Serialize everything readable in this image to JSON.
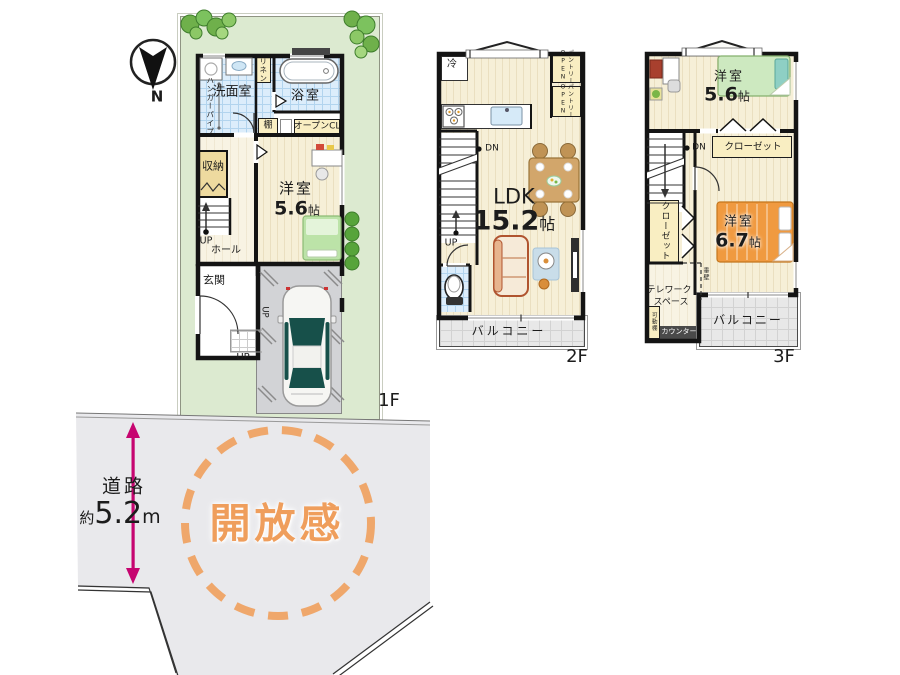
{
  "compass": {
    "north": "N"
  },
  "site": {
    "road": "道路",
    "approx": "約",
    "road_width": "5.2",
    "unit_m": "m",
    "openness": "開放感"
  },
  "units": {
    "jo": "帖"
  },
  "f1": {
    "label": "1F",
    "washroom": "洗面室",
    "bath": "浴室",
    "linen": "リネン",
    "hanger_pipe": "ハンガーパイプ",
    "shelf": "棚",
    "open_closet": "オープンCL",
    "storage": "収納",
    "bedroom": "洋室",
    "bedroom_size": "5.6",
    "stairs_up": "UP",
    "hall": "ホール",
    "entrance": "玄関",
    "porch_up": "UP",
    "garage_up": "UP"
  },
  "f2": {
    "label": "2F",
    "fridge": "冷",
    "pantry_open": "OPEN",
    "pantry": "パントリー",
    "stairs_dn": "DN",
    "ldk": "LDK",
    "ldk_size": "15.2",
    "stairs_up": "UP",
    "balcony": "バルコニー"
  },
  "f3": {
    "label": "3F",
    "bedroom1": "洋室",
    "bedroom1_size": "5.6",
    "closet": "クローゼット",
    "stairs_dn": "DN",
    "closet2": "クローゼット",
    "bedroom2": "洋室",
    "bedroom2_size": "6.7",
    "telework1": "テレワーク",
    "telework2": "スペース",
    "movable_shelf": "可動棚",
    "counter": "カウンター",
    "hanging_wall": "垂壁",
    "balcony": "バルコニー"
  },
  "colors": {
    "lot_green": "#dcead0",
    "road_gray": "#e9e9ec",
    "accent_orange": "#ef9e5c",
    "arrow_magenta": "#c60570",
    "tile_blue": "#dcedfb",
    "label_cream": "#f9eec2",
    "wood": "#f6efd7"
  }
}
